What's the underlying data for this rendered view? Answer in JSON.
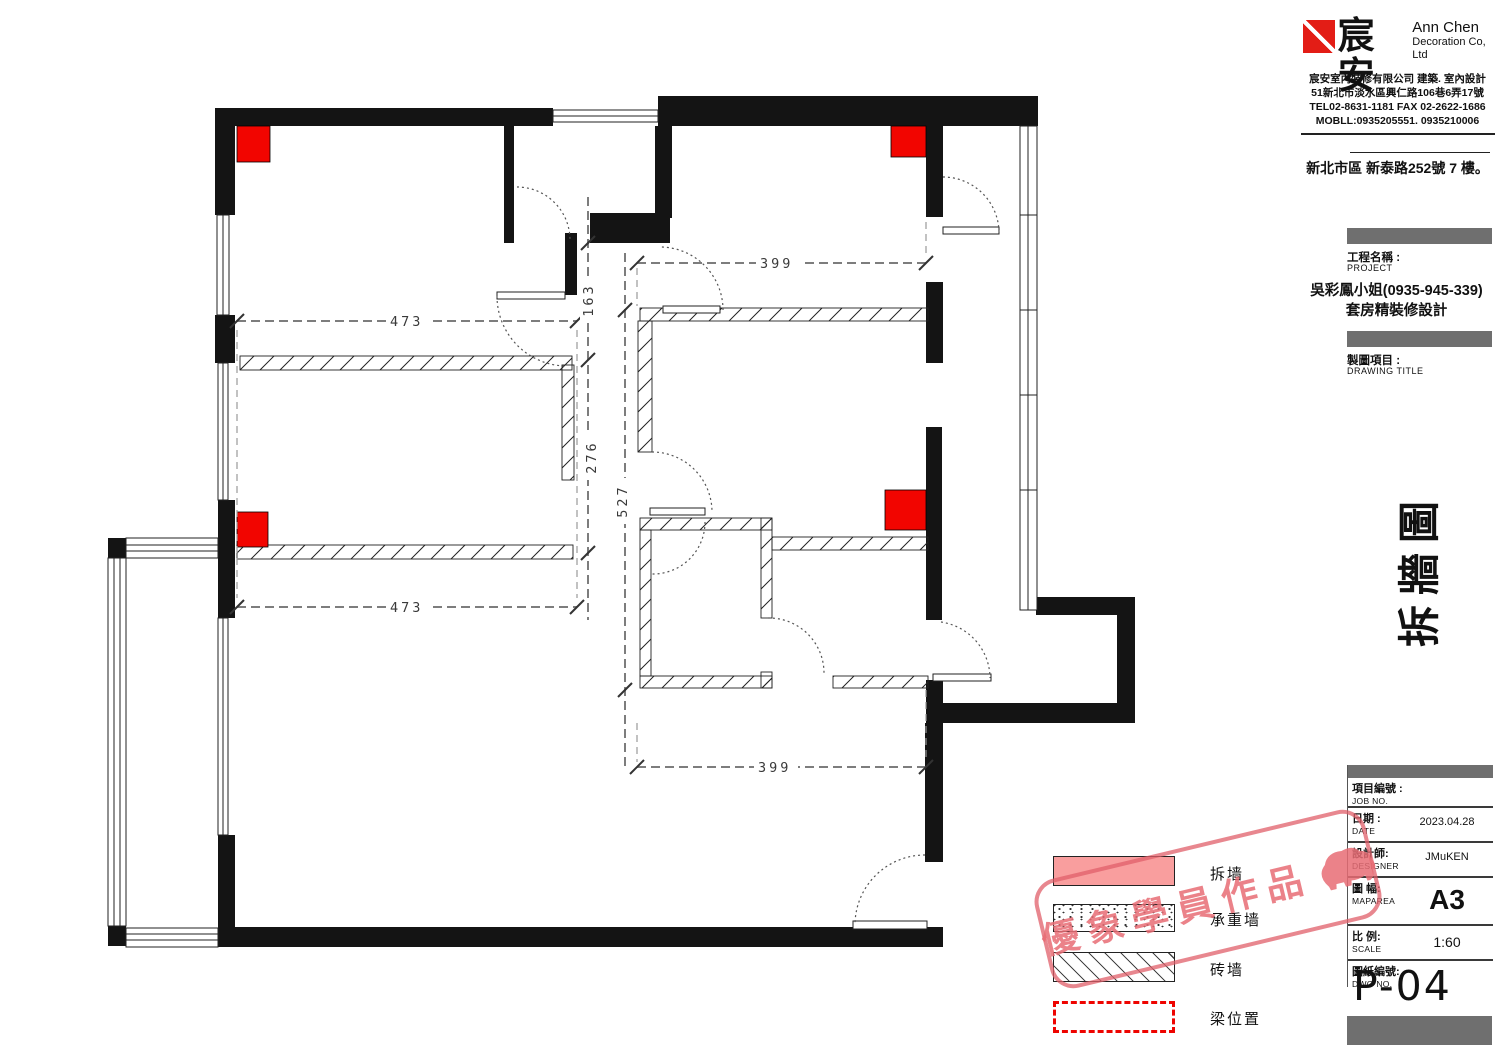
{
  "header": {
    "brand_cn": "宸安",
    "brand_en1": "Ann Chen",
    "brand_en2": "Decoration Co, Ltd",
    "company_line": "宸安室內裝修有限公司 建築. 室內設計",
    "address_line": "51新北市淡水區興仁路106巷6弄17號",
    "tel_line": "TEL02-8631-1181 FAX 02-2622-1686",
    "mobile_line": "MOBLL:0935205551. 0935210006",
    "site_address": "新北市區 新泰路252號 7 樓。"
  },
  "project": {
    "label_cn": "工程名稱 :",
    "label_en": "PROJECT",
    "name_line1": "吳彩鳳小姐(0935-945-339)",
    "name_line2": "套房精裝修設計"
  },
  "drawing": {
    "label_cn": "製圖項目 :",
    "label_en": "DRAWING TITLE",
    "title_vertical": "拆牆圖"
  },
  "titleblock": {
    "rows": [
      {
        "cn": "項目編號 :",
        "en": "JOB NO.",
        "value": ""
      },
      {
        "cn": "日期 :",
        "en": "DATE",
        "value": "2023.04.28"
      },
      {
        "cn": "設計師:",
        "en": "DESIGNER",
        "value": "JMuKEN"
      },
      {
        "cn": "圖 幅:",
        "en": "MAPAREA",
        "value": "A3"
      },
      {
        "cn": "比 例:",
        "en": "SCALE",
        "value": "1:60"
      },
      {
        "cn": "圖紙編號:",
        "en": "DWG NO.",
        "value": ""
      }
    ],
    "sheet_no": "P-04"
  },
  "legend": {
    "items": [
      {
        "label": "拆墙"
      },
      {
        "label": "承重墙"
      },
      {
        "label": "砖墙"
      },
      {
        "label": "梁位置"
      }
    ]
  },
  "watermark": {
    "text": "優象學員作品"
  },
  "plan": {
    "dims": {
      "d473a": "473",
      "d473b": "473",
      "d399a": "399",
      "d399b": "399",
      "d163": "163",
      "d276": "276",
      "d527": "527"
    }
  },
  "colors": {
    "column_red": "#f20500",
    "legend_pink": "#f99e9e",
    "bar_gray": "#6f6f6f",
    "stamp_pink": "#e06a72"
  }
}
